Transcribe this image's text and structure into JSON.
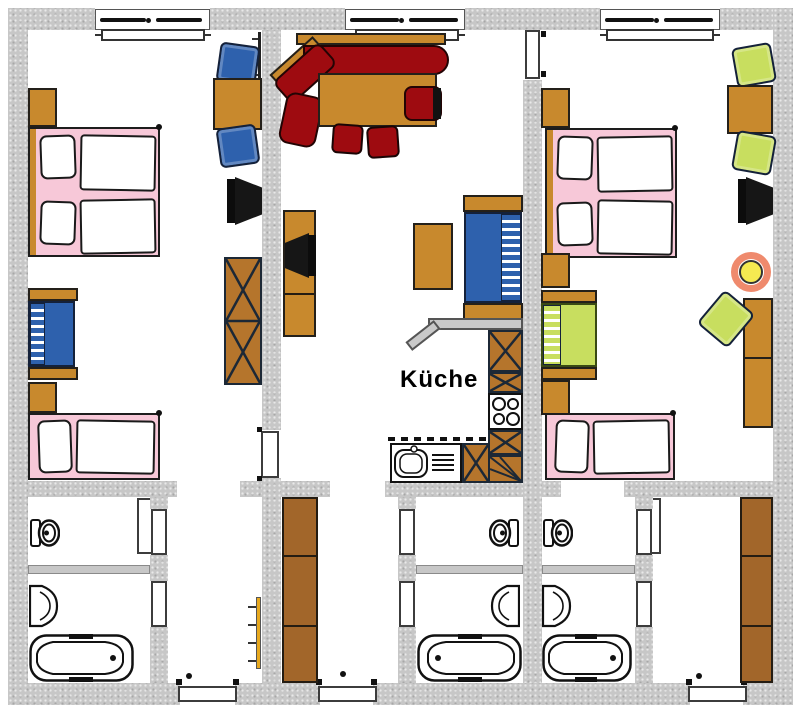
{
  "labels": {
    "kitchen": "Küche"
  },
  "colors": {
    "wall": "#c7c7c7",
    "wood": "#c8892d",
    "cabinet": "#b5752c",
    "wardrobe": "#a2662a",
    "bedpink": "#f7c8d8",
    "sofared": "#9e0b10",
    "blue": "#2e61ad",
    "green": "#c8de5f",
    "lampyellow": "#f5ea51",
    "lampring": "#ef8a6d",
    "radyellow": "#e8a91e",
    "outline": "#1d1d1d"
  }
}
